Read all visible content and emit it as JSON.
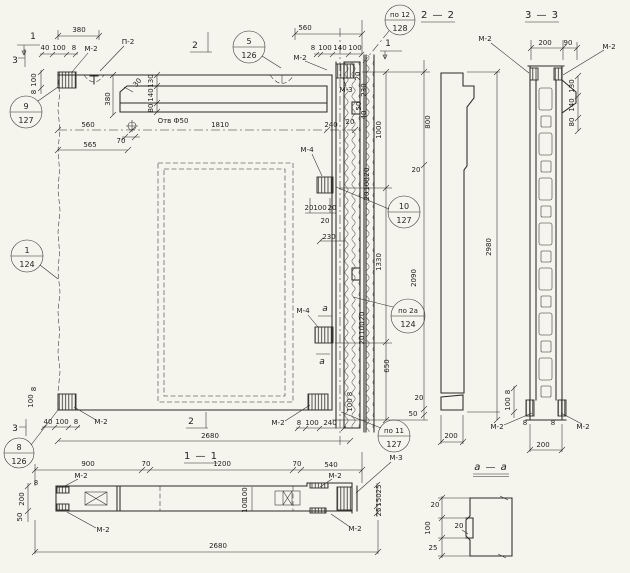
{
  "title_note": "panel shop drawing",
  "colors": {
    "paper": "#f5f4ed",
    "ink": "#2c2b26"
  },
  "labels": {
    "m2": "М-2",
    "m3": "М-3",
    "m4": "М-4",
    "p2": "П-2",
    "hole": "Отв Ф50",
    "sec11": "1 — 1",
    "sec22": "2 — 2",
    "sec33": "3 — 3",
    "secaa": "а — а",
    "cut1": "1",
    "cut2": "2",
    "cut3": "3",
    "cuta": "а"
  },
  "callouts": {
    "c9": {
      "num": "9",
      "sheet": "127"
    },
    "c1": {
      "num": "1",
      "sheet": "124"
    },
    "c8": {
      "num": "8",
      "sheet": "126"
    },
    "c5": {
      "num": "5",
      "sheet": "126"
    },
    "c12": {
      "num": "по 12",
      "sheet": "128"
    },
    "c10": {
      "num": "10",
      "sheet": "127"
    },
    "c2a": {
      "num": "по 2а",
      "sheet": "124"
    },
    "c11": {
      "num": "по 11",
      "sheet": "127"
    }
  },
  "dims": {
    "d8": "8",
    "d20": "20",
    "d25": "25",
    "d30": "30",
    "d40": "40",
    "d50": "50",
    "d70": "70",
    "d80": "80",
    "d90": "90",
    "d100": "100",
    "d130": "130",
    "d140": "140",
    "d150": "150",
    "d200": "200",
    "d230": "230",
    "d240": "240",
    "d380": "380",
    "d540": "540",
    "d560": "560",
    "d565": "565",
    "d650": "650",
    "d800": "800",
    "d900": "900",
    "d1000": "1000",
    "d1200": "1200",
    "d1330": "1330",
    "d1810": "1810",
    "d2090": "2090",
    "d2680": "2680",
    "d2980": "2980"
  }
}
